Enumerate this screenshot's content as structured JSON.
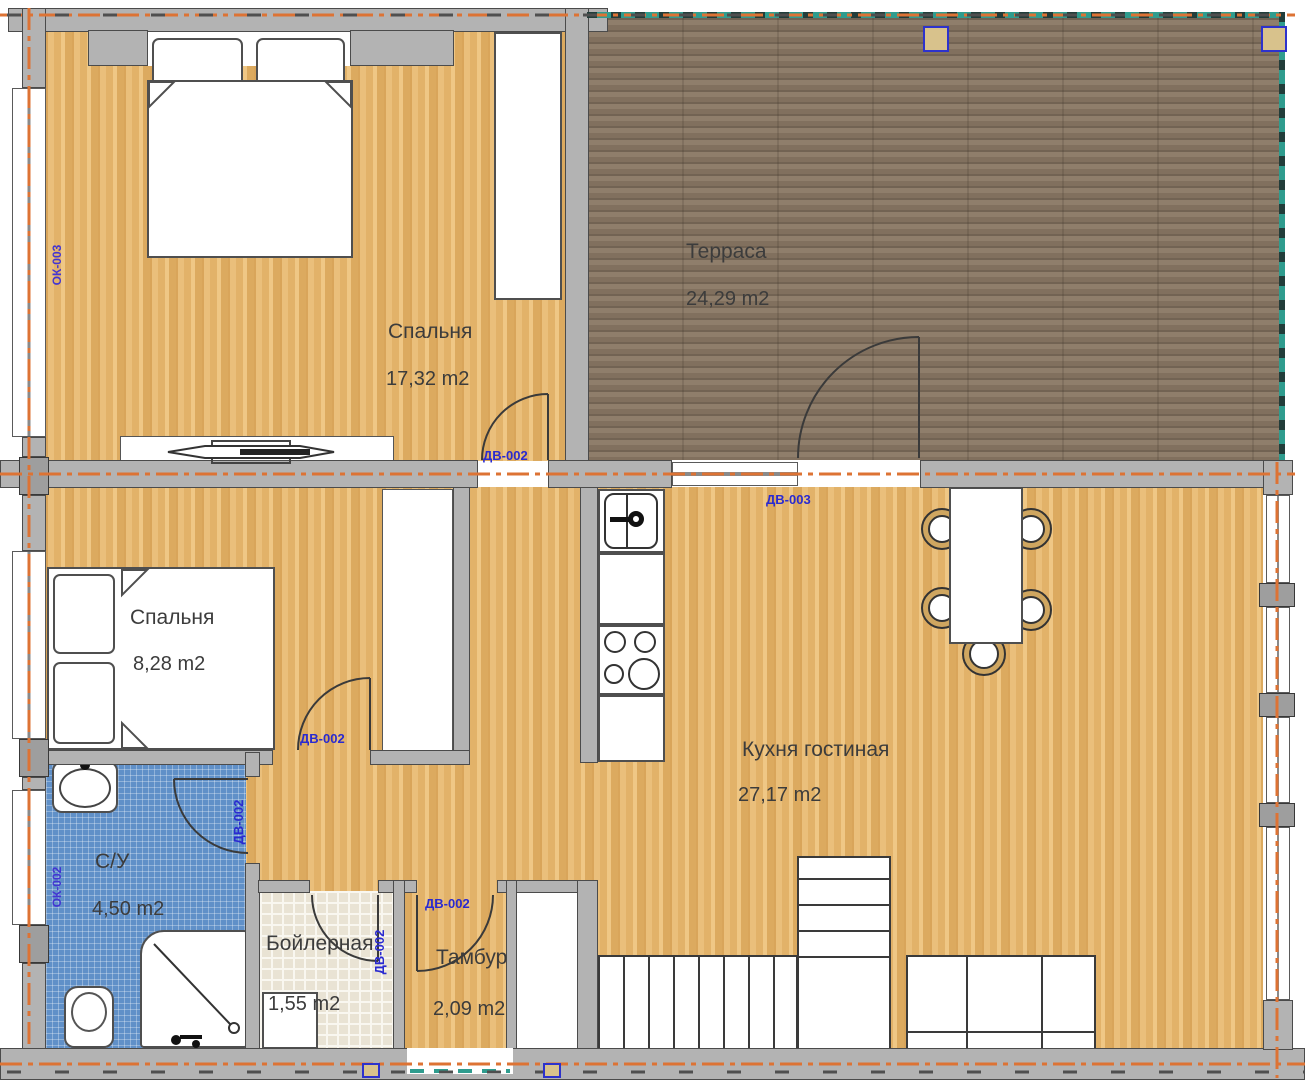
{
  "title": "Floor plan — first floor",
  "rooms": {
    "bedroom1": {
      "name": "Спальня",
      "area": "17,32 m2"
    },
    "bedroom2": {
      "name": "Спальня",
      "area": "8,28 m2"
    },
    "terrace": {
      "name": "Терраса",
      "area": "24,29 m2"
    },
    "kitchen": {
      "name": "Кухня гостиная",
      "area": "27,17 m2"
    },
    "bathroom": {
      "name": "С/У",
      "area": "4,50 m2"
    },
    "boiler": {
      "name": "Бойлерная",
      "area": "1,55 m2"
    },
    "tambour": {
      "name": "Тамбур",
      "area": "2,09 m2"
    }
  },
  "door_labels": {
    "dv002": "ДВ-002",
    "dv003": "ДВ-003"
  },
  "window_labels": {
    "ok002": "ОК-002",
    "ok003": "ОК-003"
  },
  "colors": {
    "wood_light": "#e4b56e",
    "wood_dark": "#8b7a67",
    "tile_blue": "#6090c8",
    "tile_beige": "#e9e3d4",
    "wall_gray": "#b3b3b3",
    "axis_orange": "#dd7334",
    "terrace_edge_teal": "#2f9c8e",
    "label_blue": "#2a2ad0"
  }
}
